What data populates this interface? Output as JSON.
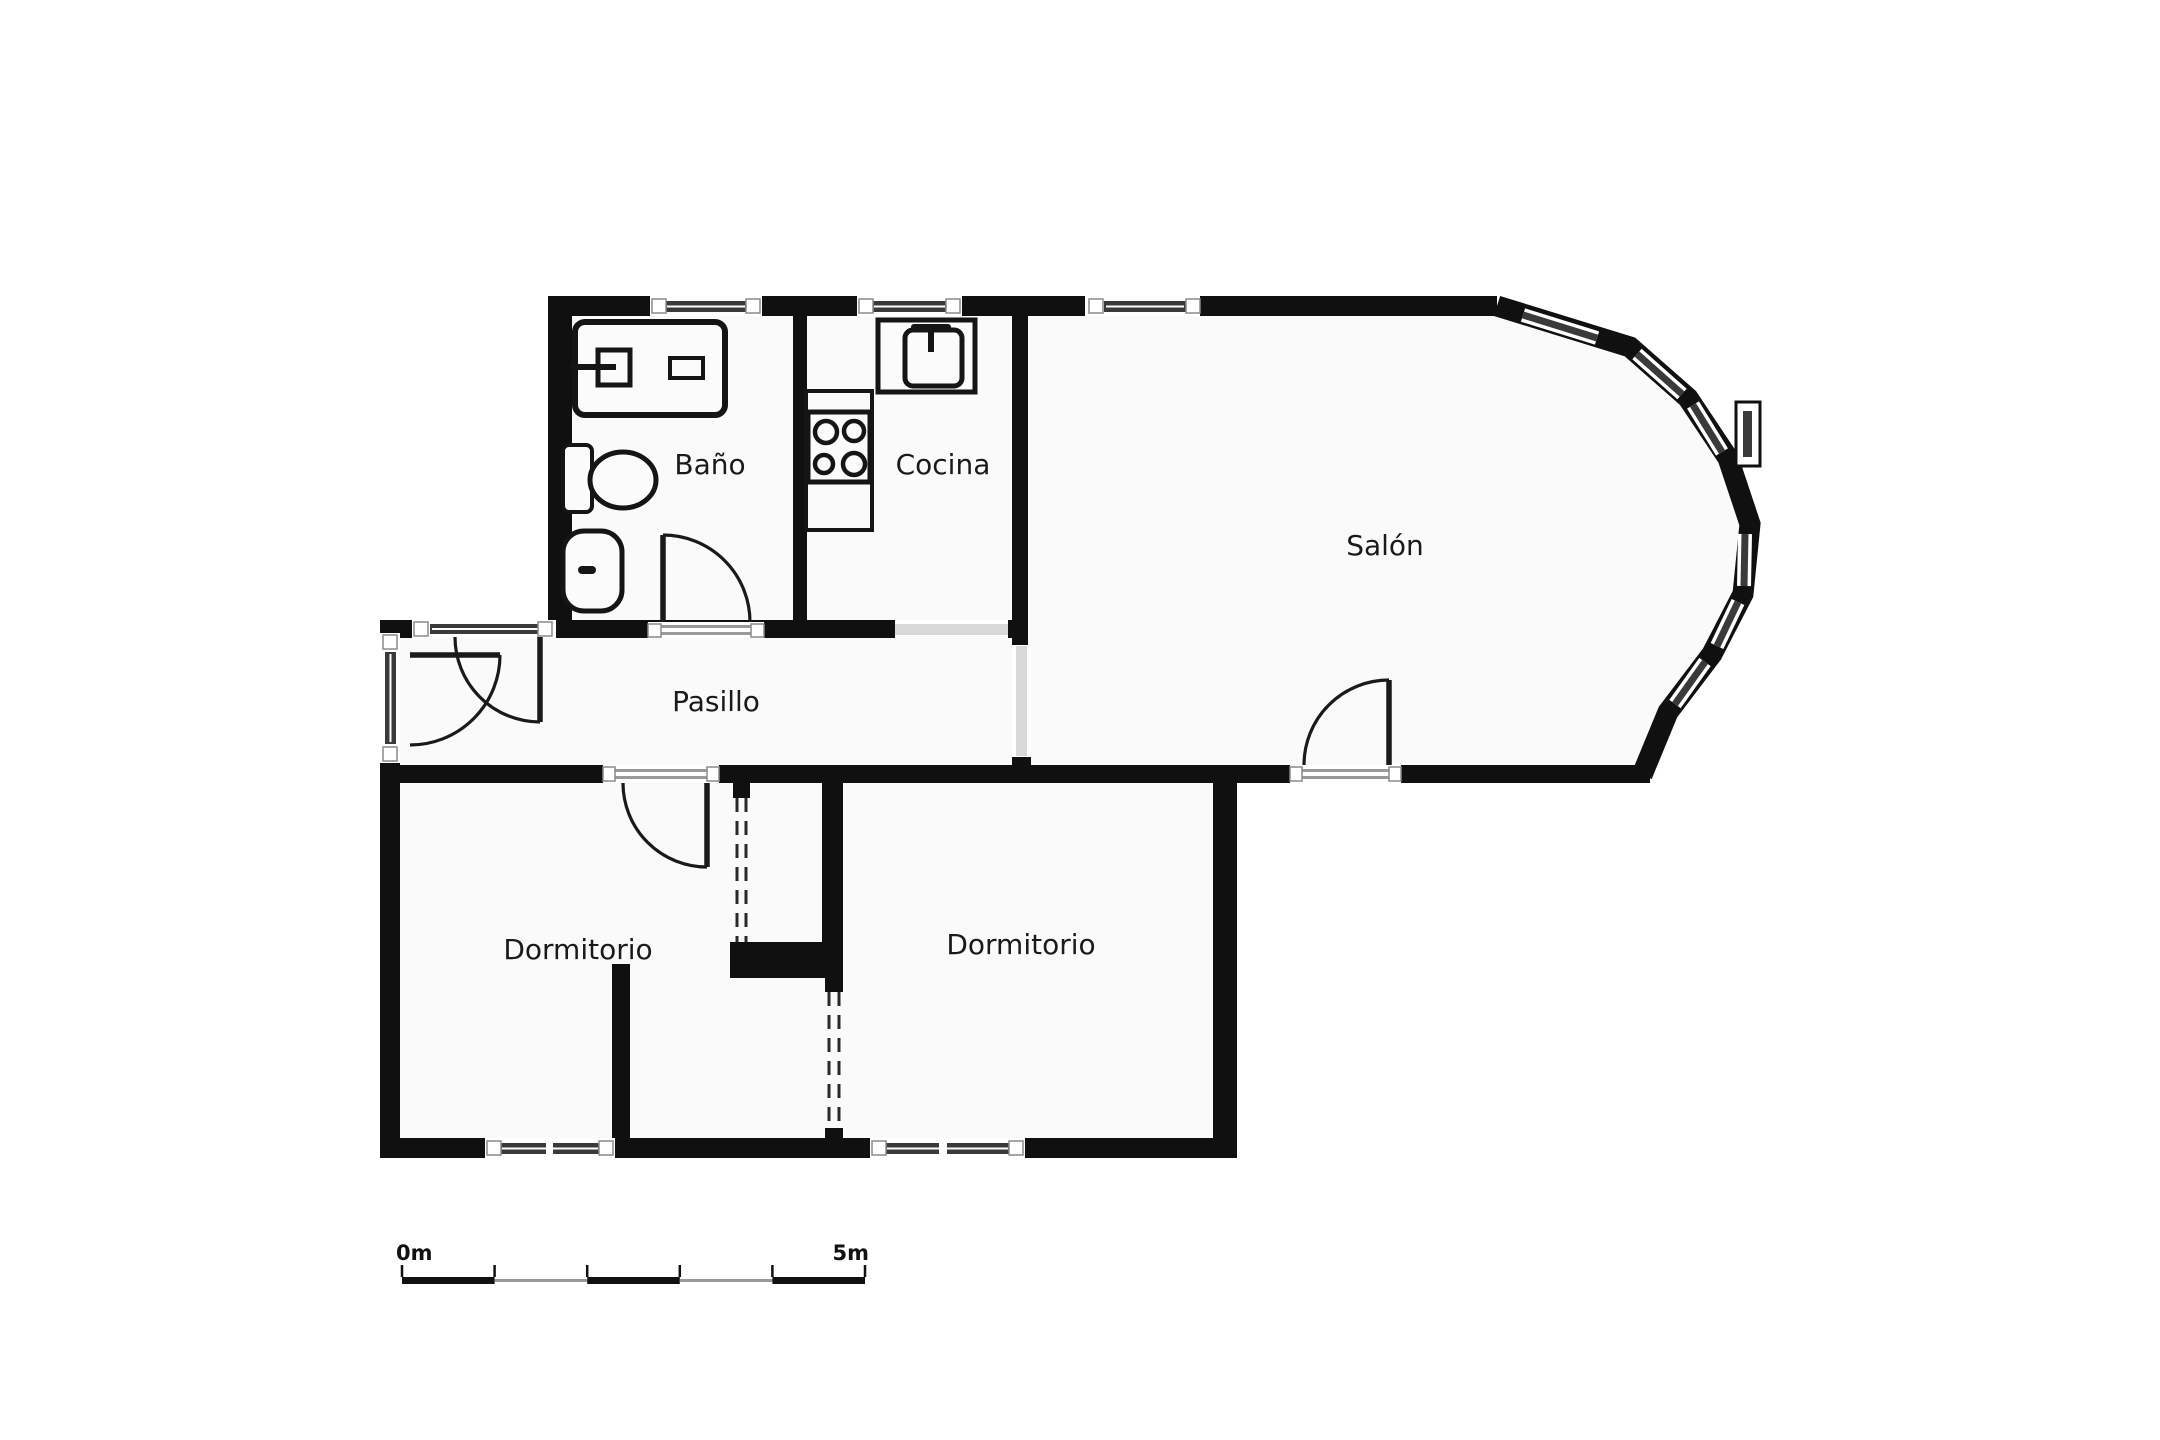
{
  "title": "apartment-floor-plan",
  "colors": {
    "wall": "#101010",
    "floor": "#fafafa",
    "outside": "#ffffff",
    "glass": "#3a3a3a",
    "glass_line": "#ffffff",
    "frame": "#ffffff",
    "frame_edge": "#8a8a8a",
    "passage": "#d9d9d9",
    "door_line": "#1a1a1a",
    "dash": "#2a2a2a",
    "threshold": "#9a9a9a",
    "text": "#1a1a1a",
    "scale_dark": "#111111",
    "scale_gray": "#999999"
  },
  "rooms": [
    {
      "id": "bano",
      "label": "Baño",
      "x": 710,
      "y": 466,
      "size": 28
    },
    {
      "id": "cocina",
      "label": "Cocina",
      "x": 943,
      "y": 466,
      "size": 28
    },
    {
      "id": "salon",
      "label": "Salón",
      "x": 1385,
      "y": 547,
      "size": 28
    },
    {
      "id": "pasillo",
      "label": "Pasillo",
      "x": 716,
      "y": 703,
      "size": 28
    },
    {
      "id": "dormitorio-1",
      "label": "Dormitorio",
      "x": 578,
      "y": 951,
      "size": 28
    },
    {
      "id": "dormitorio-2",
      "label": "Dormitorio",
      "x": 1021,
      "y": 946,
      "size": 28
    }
  ],
  "plan": {
    "floor_path": "M560,306 L1497,306 L1630,347 L1688,398 L1728,458 L1750,524 L1743,594 L1712,654 L1668,712 L1642,774 L1237,774 L1237,1148 L390,1148 L390,630 L560,630 Z",
    "walls": [
      {
        "name": "wall-top",
        "x": 548,
        "y": 296,
        "w": 949,
        "h": 20
      },
      {
        "name": "wall-bath-left",
        "x": 548,
        "y": 296,
        "w": 24,
        "h": 342
      },
      {
        "name": "wall-pasillo-top-band",
        "x": 380,
        "y": 620,
        "w": 648,
        "h": 18
      },
      {
        "name": "wall-bath-cocina-divider",
        "x": 793,
        "y": 316,
        "w": 14,
        "h": 306
      },
      {
        "name": "wall-cocina-salon-divider",
        "x": 1012,
        "y": 316,
        "w": 16,
        "h": 329
      },
      {
        "name": "wall-cocina-salon-stub",
        "x": 1012,
        "y": 753,
        "w": 19,
        "h": 14
      },
      {
        "name": "wall-pasillo-left",
        "x": 380,
        "y": 620,
        "w": 20,
        "h": 163
      },
      {
        "name": "wall-south-band",
        "x": 380,
        "y": 765,
        "w": 1270,
        "h": 18
      },
      {
        "name": "wall-dorm-left",
        "x": 380,
        "y": 765,
        "w": 20,
        "h": 393
      },
      {
        "name": "wall-bottom",
        "x": 380,
        "y": 1138,
        "w": 857,
        "h": 20
      },
      {
        "name": "wall-dorm2-right",
        "x": 1213,
        "y": 765,
        "w": 24,
        "h": 393
      },
      {
        "name": "wall-closet-right",
        "x": 822,
        "y": 783,
        "w": 21,
        "h": 175
      },
      {
        "name": "wall-closet-middle",
        "x": 730,
        "y": 942,
        "w": 113,
        "h": 36
      },
      {
        "name": "wall-dorm-divider-low",
        "x": 612,
        "y": 964,
        "w": 18,
        "h": 174
      },
      {
        "name": "wall-p1-cap-top",
        "x": 733,
        "y": 783,
        "w": 17,
        "h": 15
      },
      {
        "name": "wall-p2-cap-top",
        "x": 825,
        "y": 978,
        "w": 18,
        "h": 14
      },
      {
        "name": "wall-p2-cap-bottom",
        "x": 825,
        "y": 1128,
        "w": 18,
        "h": 12
      }
    ],
    "bay": {
      "name": "bay-window-wall",
      "points": "1497,306 1630,347 1688,398 1728,458 1750,524 1743,594 1712,654 1668,712 1642,775",
      "stroke_width": 21
    },
    "bay_glazings": [
      {
        "name": "bay-glazing-1",
        "x1": 1523,
        "y1": 315,
        "x2": 1597,
        "y2": 338
      },
      {
        "name": "bay-glazing-2",
        "x1": 1637,
        "y1": 354,
        "x2": 1682,
        "y2": 394
      },
      {
        "name": "bay-glazing-3",
        "x1": 1693,
        "y1": 405,
        "x2": 1722,
        "y2": 452
      },
      {
        "name": "bay-glazing-4",
        "x1": 1745,
        "y1": 534,
        "x2": 1744,
        "y2": 586
      },
      {
        "name": "bay-glazing-5",
        "x1": 1738,
        "y1": 602,
        "x2": 1717,
        "y2": 646
      },
      {
        "name": "bay-glazing-6",
        "x1": 1705,
        "y1": 662,
        "x2": 1675,
        "y2": 704
      }
    ],
    "bay_protruding_window": {
      "name": "bay-protruding-window",
      "outer": {
        "x": 1736,
        "y": 402,
        "w": 24,
        "h": 64
      },
      "inner": {
        "x": 1743,
        "y": 411,
        "w": 9,
        "h": 46
      }
    },
    "windows": [
      {
        "name": "window-bath-top",
        "white": [
          650,
          296,
          112,
          20
        ],
        "glass": [
          665,
          301,
          82,
          11
        ],
        "frames": [
          [
            652,
            299,
            14,
            14
          ],
          [
            746,
            299,
            14,
            14
          ]
        ],
        "mullions": []
      },
      {
        "name": "window-cocina-top",
        "white": [
          857,
          296,
          105,
          20
        ],
        "glass": [
          872,
          301,
          75,
          11
        ],
        "frames": [
          [
            859,
            299,
            14,
            14
          ],
          [
            946,
            299,
            14,
            14
          ]
        ],
        "mullions": []
      },
      {
        "name": "window-salon-top",
        "white": [
          1085,
          296,
          115,
          20
        ],
        "glass": [
          1104,
          301,
          82,
          11
        ],
        "frames": [
          [
            1089,
            299,
            14,
            14
          ],
          [
            1186,
            299,
            14,
            14
          ]
        ],
        "mullions": []
      },
      {
        "name": "window-pasillo-left",
        "white": [
          380,
          633,
          20,
          130
        ],
        "glass": [
          385,
          652,
          11,
          92
        ],
        "frames": [
          [
            383,
            635,
            14,
            14
          ],
          [
            383,
            747,
            14,
            14
          ]
        ],
        "mullions": []
      },
      {
        "name": "window-pasillo-top",
        "white": [
          412,
          620,
          144,
          18
        ],
        "glass": [
          430,
          624,
          110,
          10
        ],
        "frames": [
          [
            414,
            622,
            14,
            14
          ],
          [
            538,
            622,
            14,
            14
          ]
        ],
        "mullions": []
      },
      {
        "name": "window-dorm1-bottom",
        "white": [
          485,
          1138,
          130,
          20
        ],
        "glass": [
          500,
          1143,
          100,
          11
        ],
        "frames": [
          [
            487,
            1141,
            14,
            14
          ],
          [
            599,
            1141,
            14,
            14
          ]
        ],
        "mullions": [
          [
            546,
            1141,
            7,
            14
          ]
        ]
      },
      {
        "name": "window-dorm2-bottom",
        "white": [
          870,
          1138,
          155,
          20
        ],
        "glass": [
          885,
          1143,
          125,
          11
        ],
        "frames": [
          [
            872,
            1141,
            14,
            14
          ],
          [
            1009,
            1141,
            14,
            14
          ]
        ],
        "mullions": [
          [
            939,
            1141,
            8,
            14
          ]
        ]
      }
    ],
    "passages": [
      {
        "name": "passage-cocina-pasillo",
        "white": [
          895,
          620,
          113,
          18
        ],
        "gray": [
          895,
          624,
          113,
          11
        ]
      },
      {
        "name": "passage-pasillo-salon",
        "white": [
          1012,
          645,
          19,
          112
        ],
        "gray": [
          1016,
          646,
          11,
          110
        ]
      }
    ],
    "doors": [
      {
        "name": "door-bath",
        "opening": [
          648,
          622,
          116,
          16
        ],
        "frames": [
          [
            648,
            624,
            13,
            13
          ],
          [
            751,
            624,
            13,
            13
          ]
        ],
        "threshold": [
          [
            661,
            625,
            90,
            3
          ],
          [
            661,
            632,
            90,
            3
          ]
        ],
        "leaf": "M663,535 L663,622",
        "arc": "M663,535 A87,87 0 0 1 750,622"
      },
      {
        "name": "door-entry-a",
        "opening": null,
        "frames": [],
        "threshold": [],
        "leaf": "M540,637 L540,722",
        "arc": "M540,722 A85,85 0 0 1 455,637"
      },
      {
        "name": "door-entry-b",
        "opening": null,
        "frames": [],
        "threshold": [],
        "leaf": "M410,655 L500,655",
        "arc": "M500,655 A90,90 0 0 1 410,745"
      },
      {
        "name": "door-dormitorio-1",
        "opening": [
          603,
          765,
          116,
          18
        ],
        "frames": [
          [
            603,
            767,
            12,
            14
          ],
          [
            707,
            767,
            12,
            14
          ]
        ],
        "threshold": [
          [
            615,
            769,
            92,
            3
          ],
          [
            615,
            776,
            92,
            3
          ]
        ],
        "leaf": "M707,783 L707,867",
        "arc": "M707,867 A84,84 0 0 1 623,783"
      },
      {
        "name": "door-salon",
        "opening": [
          1290,
          765,
          111,
          18
        ],
        "frames": [
          [
            1290,
            767,
            12,
            14
          ],
          [
            1389,
            767,
            12,
            14
          ]
        ],
        "threshold": [
          [
            1302,
            769,
            87,
            3
          ],
          [
            1302,
            776,
            87,
            3
          ]
        ],
        "leaf": "M1389,680 L1389,765",
        "arc": "M1389,680 A85,85 0 0 0 1304,765"
      }
    ],
    "dashed_partitions": [
      {
        "name": "wardrobe-front-upper",
        "lines": [
          [
            737,
            798,
            737,
            942
          ],
          [
            746,
            798,
            746,
            942
          ]
        ]
      },
      {
        "name": "wardrobe-front-lower",
        "lines": [
          [
            829,
            992,
            829,
            1128
          ],
          [
            839,
            992,
            839,
            1128
          ]
        ]
      }
    ],
    "fixtures": [
      {
        "name": "vanity-counter",
        "tag": "rect",
        "a": {
          "x": 575,
          "y": 322,
          "width": 150,
          "height": 93,
          "rx": 10,
          "fill": "#fbfbfb",
          "stroke": "#151515",
          "stroke-width": 6
        }
      },
      {
        "name": "vanity-sink",
        "tag": "rect",
        "a": {
          "x": 598,
          "y": 350,
          "width": 32,
          "height": 35,
          "fill": "none",
          "stroke": "#151515",
          "stroke-width": 5
        }
      },
      {
        "name": "vanity-faucet",
        "tag": "rect",
        "a": {
          "x": 570,
          "y": 364,
          "width": 46,
          "height": 6,
          "fill": "#151515"
        }
      },
      {
        "name": "vanity-soap-dish",
        "tag": "rect",
        "a": {
          "x": 670,
          "y": 358,
          "width": 33,
          "height": 20,
          "fill": "none",
          "stroke": "#151515",
          "stroke-width": 4
        }
      },
      {
        "name": "toilet-tank",
        "tag": "rect",
        "a": {
          "x": 563,
          "y": 445,
          "width": 29,
          "height": 67,
          "rx": 6,
          "fill": "#fbfbfb",
          "stroke": "#151515",
          "stroke-width": 4
        }
      },
      {
        "name": "toilet-bowl",
        "tag": "ellipse",
        "a": {
          "cx": 623,
          "cy": 480,
          "rx": 33,
          "ry": 28,
          "fill": "#fbfbfb",
          "stroke": "#151515",
          "stroke-width": 5
        }
      },
      {
        "name": "bidet-body",
        "tag": "rect",
        "a": {
          "x": 563,
          "y": 531,
          "width": 59,
          "height": 80,
          "rx": 21,
          "fill": "#fbfbfb",
          "stroke": "#151515",
          "stroke-width": 5
        }
      },
      {
        "name": "bidet-faucet",
        "tag": "rect",
        "a": {
          "x": 578,
          "y": 566,
          "width": 18,
          "height": 8,
          "rx": 4,
          "fill": "#151515"
        }
      },
      {
        "name": "kitchen-sink-counter",
        "tag": "rect",
        "a": {
          "x": 878,
          "y": 320,
          "width": 97,
          "height": 72,
          "fill": "#fbfbfb",
          "stroke": "#151515",
          "stroke-width": 5
        }
      },
      {
        "name": "kitchen-sink",
        "tag": "rect",
        "a": {
          "x": 905,
          "y": 330,
          "width": 57,
          "height": 56,
          "rx": 8,
          "fill": "#fbfbfb",
          "stroke": "#151515",
          "stroke-width": 5
        }
      },
      {
        "name": "kitchen-faucet-bar",
        "tag": "rect",
        "a": {
          "x": 911,
          "y": 324,
          "width": 40,
          "height": 6,
          "rx": 3,
          "fill": "#151515"
        }
      },
      {
        "name": "kitchen-faucet-stem",
        "tag": "rect",
        "a": {
          "x": 928,
          "y": 330,
          "width": 6,
          "height": 22,
          "fill": "#151515"
        }
      },
      {
        "name": "kitchen-counter",
        "tag": "rect",
        "a": {
          "x": 806,
          "y": 391,
          "width": 66,
          "height": 139,
          "fill": "none",
          "stroke": "#151515",
          "stroke-width": 4
        }
      },
      {
        "name": "hob",
        "tag": "rect",
        "a": {
          "x": 808,
          "y": 412,
          "width": 62,
          "height": 70,
          "fill": "#fbfbfb",
          "stroke": "#151515",
          "stroke-width": 5
        }
      },
      {
        "name": "hob-burner-1",
        "tag": "circle",
        "a": {
          "cx": 826,
          "cy": 432,
          "r": 11,
          "fill": "none",
          "stroke": "#151515",
          "stroke-width": 4.5
        }
      },
      {
        "name": "hob-burner-2",
        "tag": "circle",
        "a": {
          "cx": 854,
          "cy": 431,
          "r": 10,
          "fill": "none",
          "stroke": "#151515",
          "stroke-width": 4.5
        }
      },
      {
        "name": "hob-burner-3",
        "tag": "circle",
        "a": {
          "cx": 824,
          "cy": 464,
          "r": 9,
          "fill": "none",
          "stroke": "#151515",
          "stroke-width": 4.5
        }
      },
      {
        "name": "hob-burner-4",
        "tag": "circle",
        "a": {
          "cx": 854,
          "cy": 464,
          "r": 11,
          "fill": "none",
          "stroke": "#151515",
          "stroke-width": 4.5
        }
      }
    ]
  },
  "scale_bar": {
    "label_start": "0m",
    "label_end": "5m",
    "x0": 402,
    "x1": 865,
    "segments": 5,
    "bar_y": 1277,
    "tick_y": 1265,
    "label_y": 1260,
    "font_size": 21
  }
}
